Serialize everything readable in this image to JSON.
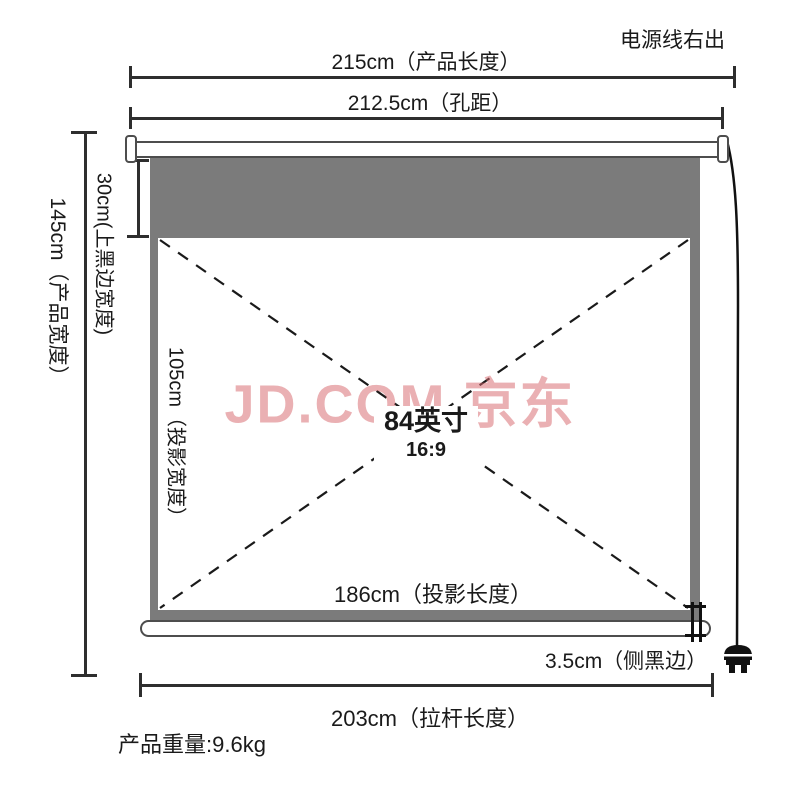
{
  "title": "投影幕布产品尺寸示意图",
  "watermark": "JD.COM 京东",
  "notes": {
    "power_cable_exit": "电源线右出",
    "product_weight": "产品重量:9.6kg"
  },
  "screen": {
    "size_label": "84英寸",
    "aspect_ratio": "16:9"
  },
  "dimensions": {
    "product_length": "215cm（产品长度）",
    "hole_distance": "212.5cm（孔距）",
    "product_width": "145cm（产品宽度）",
    "top_black_edge_width": "30cm(上黑边宽度)",
    "projection_width": "105cm（投影宽度）",
    "projection_length": "186cm（投影长度）",
    "side_black_edge": "3.5cm（侧黑边）",
    "rod_length": "203cm（拉杆长度）"
  },
  "icons": {
    "power_plug": "power-plug-icon",
    "power_cable": "power-cable-line"
  },
  "colors": {
    "line": "#2e2e2e",
    "screen_gray": "#7b7b7b",
    "watermark_pink": "rgba(214,104,110,0.52)",
    "text": "#1a1a1a"
  }
}
